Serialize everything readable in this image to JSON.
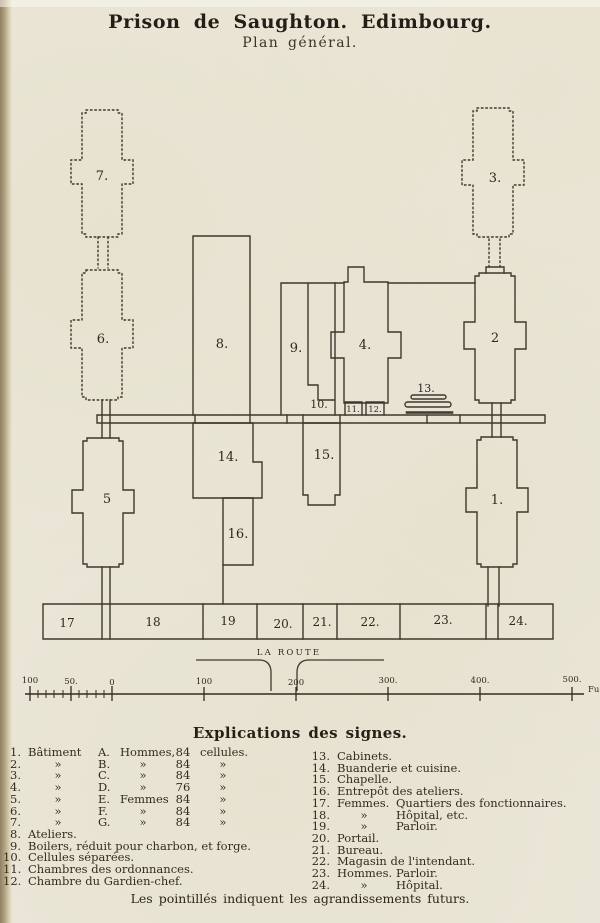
{
  "title": "Prison de Saughton. Edimbourg.",
  "subtitle": "Plan général.",
  "plan": {
    "numbers": [
      "1.",
      "2",
      "3.",
      "4.",
      "5",
      "6.",
      "7.",
      "8.",
      "9.",
      "10.",
      "11.",
      "12.",
      "13.",
      "14.",
      "15.",
      "16.",
      "17",
      "18",
      "19",
      "20.",
      "21.",
      "22.",
      "23.",
      "24."
    ],
    "route_label": "LA ROUTE",
    "scale": {
      "tick_labels": [
        "100",
        "50.",
        "0",
        "100",
        "200",
        "300.",
        "400.",
        "500."
      ],
      "unit": "Fu"
    }
  },
  "legend": {
    "title": "Explications des signes.",
    "rows_1_7": [
      {
        "n": "1.",
        "c1": "Bâtiment",
        "c2": "A.",
        "c3": "Hommes,",
        "c4": "84",
        "c5": "cellules."
      },
      {
        "n": "2.",
        "c1": "»",
        "c2": "B.",
        "c3": "»",
        "c4": "84",
        "c5": "»"
      },
      {
        "n": "3.",
        "c1": "»",
        "c2": "C.",
        "c3": "»",
        "c4": "84",
        "c5": "»"
      },
      {
        "n": "4.",
        "c1": "»",
        "c2": "D.",
        "c3": "»",
        "c4": "76",
        "c5": "»"
      },
      {
        "n": "5.",
        "c1": "»",
        "c2": "E.",
        "c3": "Femmes",
        "c4": "84",
        "c5": "»"
      },
      {
        "n": "6.",
        "c1": "»",
        "c2": "F.",
        "c3": "»",
        "c4": "84",
        "c5": "»"
      },
      {
        "n": "7.",
        "c1": "»",
        "c2": "G.",
        "c3": "»",
        "c4": "84",
        "c5": "»"
      }
    ],
    "rows_8_12": [
      {
        "n": "8.",
        "text": "Ateliers."
      },
      {
        "n": "9.",
        "text": "Boilers, réduit pour charbon, et forge."
      },
      {
        "n": "10.",
        "text": "Cellules séparées."
      },
      {
        "n": "11.",
        "text": "Chambres des ordonnances."
      },
      {
        "n": "12.",
        "text": "Chambre du Gardien-chef."
      }
    ],
    "rows_13_24": [
      {
        "n": "13.",
        "a": "Cabinets.",
        "b": ""
      },
      {
        "n": "14.",
        "a": "Buanderie et cuisine.",
        "b": ""
      },
      {
        "n": "15.",
        "a": "Chapelle.",
        "b": ""
      },
      {
        "n": "16.",
        "a": "Entrepôt des ateliers.",
        "b": ""
      },
      {
        "n": "17.",
        "a": "Femmes.",
        "b": "Quartiers des fonctionnaires."
      },
      {
        "n": "18.",
        "a": "»",
        "b": "Hôpital, etc."
      },
      {
        "n": "19.",
        "a": "»",
        "b": "Parloir."
      },
      {
        "n": "20.",
        "a": "Portail.",
        "b": ""
      },
      {
        "n": "21.",
        "a": "Bureau.",
        "b": ""
      },
      {
        "n": "22.",
        "a": "Magasin de l'intendant.",
        "b": ""
      },
      {
        "n": "23.",
        "a": "Hommes.",
        "b": "Parloir."
      },
      {
        "n": "24.",
        "a": "»",
        "b": "Hôpital."
      }
    ],
    "footnote": "Les pointillés indiquent les agrandissements futurs."
  },
  "colors": {
    "paper": "#eae6d7",
    "ink": "#352e23"
  }
}
